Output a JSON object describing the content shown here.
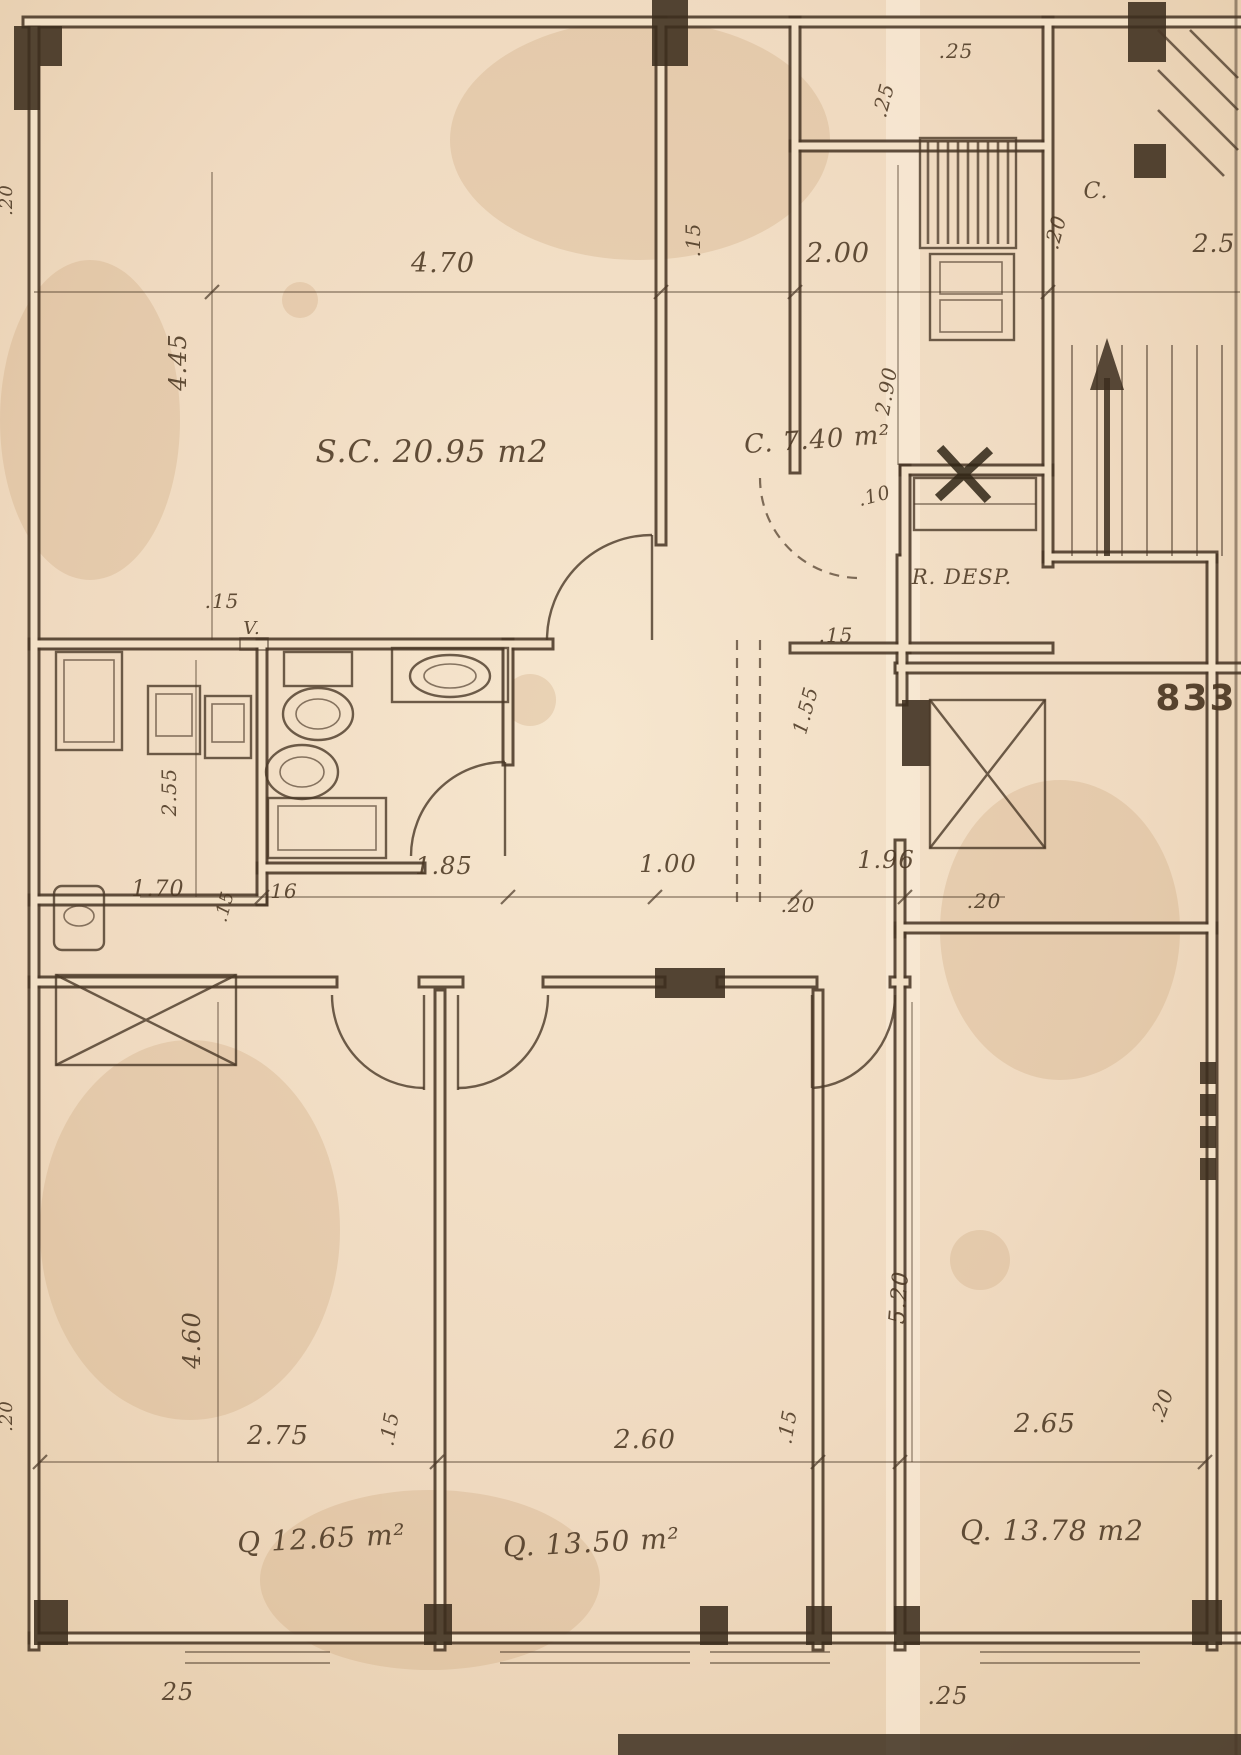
{
  "page": {
    "width": 1241,
    "height": 1755,
    "paper_color": "#efd9bf",
    "ink_color": "#4a3827",
    "stamp_number": "833"
  },
  "rooms": [
    {
      "id": "living",
      "label": "S.C. 20.95 m2"
    },
    {
      "id": "kitchen",
      "label": "C. 7.40 m²"
    },
    {
      "id": "pantry",
      "label": "R. DESP."
    },
    {
      "id": "bedroom-1",
      "label": "Q 12.65 m²"
    },
    {
      "id": "bedroom-2",
      "label": "Q. 13.50 m²"
    },
    {
      "id": "bedroom-3",
      "label": "Q. 13.78 m2"
    }
  ],
  "labels": [
    {
      "name": "room-label-living",
      "text": "S.C. 20.95 m2",
      "x": 432,
      "y": 462,
      "size": 31
    },
    {
      "name": "room-label-kitchen",
      "text": "C. 7.40 m²",
      "x": 818,
      "y": 448,
      "size": 26,
      "rot": -4
    },
    {
      "name": "room-label-pantry",
      "text": "R. DESP.",
      "x": 962,
      "y": 584,
      "size": 21
    },
    {
      "name": "room-label-bedroom-1",
      "text": "Q 12.65 m²",
      "x": 322,
      "y": 1548,
      "size": 28,
      "rot": -3
    },
    {
      "name": "room-label-bedroom-2",
      "text": "Q. 13.50 m²",
      "x": 592,
      "y": 1552,
      "size": 28,
      "rot": -3
    },
    {
      "name": "room-label-bedroom-3",
      "text": "Q. 13.78 m2",
      "x": 1052,
      "y": 1540,
      "size": 28
    },
    {
      "name": "label-c-landing",
      "text": "C.",
      "x": 1096,
      "y": 198,
      "size": 22
    },
    {
      "name": "label-vent",
      "text": "V.",
      "x": 252,
      "y": 634,
      "size": 18
    },
    {
      "name": "stamp-833",
      "text": "833",
      "x": 1196,
      "y": 710,
      "size": 36,
      "bold": true
    },
    {
      "name": "dim-top-470",
      "text": "4.70",
      "x": 443,
      "y": 272,
      "size": 27
    },
    {
      "name": "dim-top-15",
      "text": ".15",
      "x": 700,
      "y": 240,
      "size": 20,
      "rot": -90
    },
    {
      "name": "dim-top-200",
      "text": "2.00",
      "x": 838,
      "y": 262,
      "size": 27
    },
    {
      "name": "dim-top-25",
      "text": ".25",
      "x": 956,
      "y": 58,
      "size": 20
    },
    {
      "name": "dim-kitchen-25v",
      "text": ".25",
      "x": 890,
      "y": 102,
      "size": 20,
      "rot": -75
    },
    {
      "name": "dim-landing-20v",
      "text": ".20",
      "x": 1062,
      "y": 234,
      "size": 20,
      "rot": -75
    },
    {
      "name": "dim-top-right-25",
      "text": "2.5",
      "x": 1214,
      "y": 252,
      "size": 25
    },
    {
      "name": "dim-left-445",
      "text": "4.45",
      "x": 186,
      "y": 362,
      "size": 24,
      "rot": -90
    },
    {
      "name": "dim-kitchen-290",
      "text": "2.90",
      "x": 893,
      "y": 392,
      "size": 20,
      "rot": -80
    },
    {
      "name": "dim-kitchen-10",
      "text": ".10",
      "x": 876,
      "y": 502,
      "size": 19,
      "rot": -15
    },
    {
      "name": "dim-hall-15",
      "text": ".15",
      "x": 836,
      "y": 642,
      "size": 20
    },
    {
      "name": "dim-left-15",
      "text": ".15",
      "x": 222,
      "y": 608,
      "size": 20
    },
    {
      "name": "dim-left-255",
      "text": "2.55",
      "x": 176,
      "y": 792,
      "size": 20,
      "rot": -90
    },
    {
      "name": "dim-mid-185",
      "text": "1.85",
      "x": 444,
      "y": 874,
      "size": 24
    },
    {
      "name": "dim-mid-100",
      "text": "1.00",
      "x": 668,
      "y": 872,
      "size": 24
    },
    {
      "name": "dim-mid-196",
      "text": "1.96",
      "x": 886,
      "y": 868,
      "size": 24
    },
    {
      "name": "dim-mid-20a",
      "text": ".20",
      "x": 798,
      "y": 912,
      "size": 20
    },
    {
      "name": "dim-mid-20b",
      "text": ".20",
      "x": 984,
      "y": 908,
      "size": 20
    },
    {
      "name": "dim-mid-170",
      "text": "1.70",
      "x": 158,
      "y": 896,
      "size": 22
    },
    {
      "name": "dim-mid-15v",
      "text": ".15",
      "x": 230,
      "y": 908,
      "size": 18,
      "rot": -75
    },
    {
      "name": "dim-mid-16",
      "text": "16",
      "x": 284,
      "y": 898,
      "size": 20
    },
    {
      "name": "dim-hall-155v",
      "text": "1.55",
      "x": 812,
      "y": 712,
      "size": 20,
      "rot": -75
    },
    {
      "name": "dim-left-460",
      "text": "4.60",
      "x": 200,
      "y": 1340,
      "size": 24,
      "rot": -90
    },
    {
      "name": "dim-right-520",
      "text": "5.20",
      "x": 906,
      "y": 1298,
      "size": 22,
      "rot": -85
    },
    {
      "name": "dim-bot-275",
      "text": "2.75",
      "x": 278,
      "y": 1444,
      "size": 26
    },
    {
      "name": "dim-bot-15a",
      "text": ".15",
      "x": 396,
      "y": 1430,
      "size": 20,
      "rot": -80
    },
    {
      "name": "dim-bot-260",
      "text": "2.60",
      "x": 645,
      "y": 1448,
      "size": 26
    },
    {
      "name": "dim-bot-15b",
      "text": ".15",
      "x": 794,
      "y": 1428,
      "size": 20,
      "rot": -80
    },
    {
      "name": "dim-bot-265",
      "text": "2.65",
      "x": 1045,
      "y": 1432,
      "size": 26
    },
    {
      "name": "dim-bot-20v",
      "text": ".20",
      "x": 1168,
      "y": 1408,
      "size": 20,
      "rot": -70
    },
    {
      "name": "dim-edge-20-top",
      "text": ".20",
      "x": 12,
      "y": 200,
      "size": 18,
      "rot": -90
    },
    {
      "name": "dim-edge-20-bot",
      "text": ".20",
      "x": 12,
      "y": 1416,
      "size": 18,
      "rot": -90
    },
    {
      "name": "dim-bot-25-left",
      "text": "25",
      "x": 178,
      "y": 1700,
      "size": 24
    },
    {
      "name": "dim-bot-25-right",
      "text": ".25",
      "x": 948,
      "y": 1704,
      "size": 24
    }
  ]
}
